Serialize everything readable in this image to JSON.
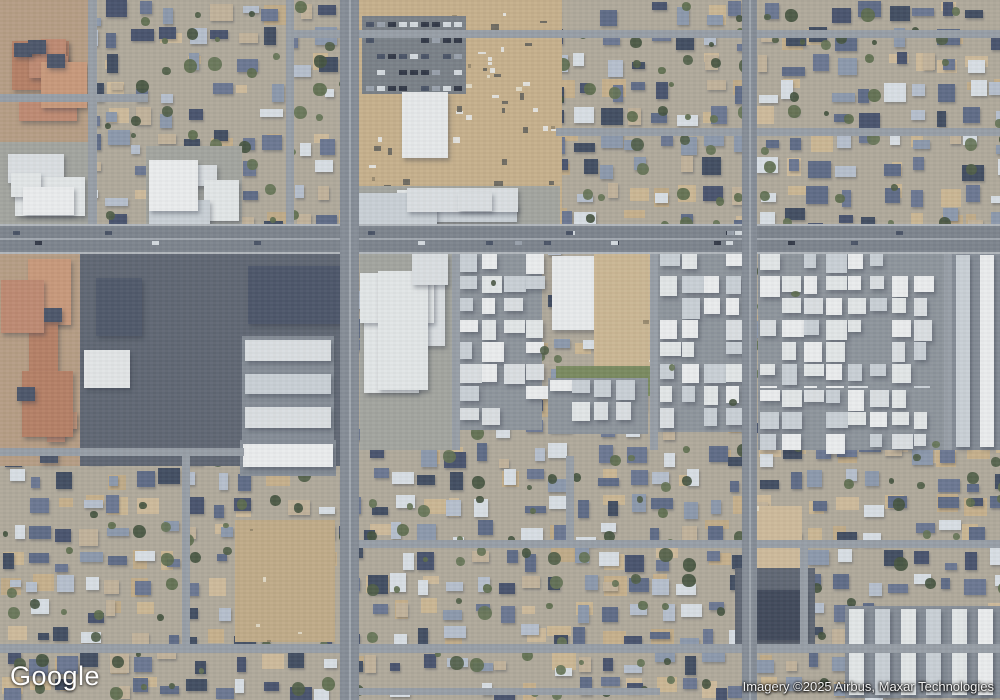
{
  "overlay": {
    "logo_text": "Google",
    "attribution_text": "Imagery ©2025 Airbus, Maxar Technologies"
  },
  "palette": {
    "base_yard": "#b3ab9b",
    "road_major": "#7d838c",
    "road_major_v": "#868d96",
    "road_minor": "#99a0a7",
    "road_stripe": "#a2a8af",
    "dirt": [
      "#cab28b",
      "#cfb993",
      "#c4ad87",
      "#d2bd9b"
    ],
    "grass": "#7a8a5c",
    "parking": "#5e6571",
    "parking_light": "#7a8086",
    "apts_bg": "#8f959c",
    "rows_bg": "#868d96",
    "comm_bg": "#a5a69f",
    "tan_bg": "#b99e83",
    "salmon": [
      "#c28a70",
      "#cc9979",
      "#b87f63"
    ],
    "white_roofs": [
      "#e8ebeb",
      "#dfe3e5",
      "#f1f2f2",
      "#cdd3d8"
    ],
    "house_colors": [
      "#46506b",
      "#5d6a85",
      "#8d99ad",
      "#b9c2cf",
      "#dde3e8",
      "#6b7691",
      "#3f4a5e",
      "#c5b49a"
    ],
    "tree_colors": [
      "#4e5c43",
      "#5c6b4a",
      "#42503b",
      "#647251"
    ],
    "car_colors": [
      "#2e3442",
      "#d8dde2",
      "#9aa2ac",
      "#475063"
    ],
    "dark_roof": "#4a5367"
  },
  "map": {
    "width": 1000,
    "height": 700,
    "zones": [
      {
        "t": "res",
        "x": 0,
        "y": 0,
        "w": 1000,
        "h": 700,
        "s": 11
      },
      {
        "t": "tan_complex",
        "x": 0,
        "y": 0,
        "w": 92,
        "h": 142,
        "s": 21
      },
      {
        "t": "comm",
        "x": 0,
        "y": 142,
        "w": 92,
        "h": 86,
        "s": 22,
        "n": 4
      },
      {
        "t": "comm",
        "x": 146,
        "y": 146,
        "w": 96,
        "h": 82,
        "s": 23,
        "n": 4
      },
      {
        "t": "dirt",
        "x": 352,
        "y": 0,
        "w": 210,
        "h": 226,
        "s": 24,
        "i": 0
      },
      {
        "t": "park_cars",
        "x": 362,
        "y": 16,
        "w": 104,
        "h": 78,
        "s": 25
      },
      {
        "t": "specks",
        "x": 466,
        "y": 8,
        "w": 92,
        "h": 180,
        "s": 27,
        "n": 26
      },
      {
        "t": "specks",
        "x": 360,
        "y": 100,
        "w": 100,
        "h": 112,
        "s": 28,
        "n": 18
      },
      {
        "t": "bldg",
        "x": 402,
        "y": 92,
        "w": 46,
        "h": 66,
        "c": "#eceeee"
      },
      {
        "t": "comm",
        "x": 350,
        "y": 186,
        "w": 210,
        "h": 42,
        "s": 29,
        "n": 6
      },
      {
        "t": "tan_complex",
        "x": 0,
        "y": 252,
        "w": 80,
        "h": 214,
        "s": 31
      },
      {
        "t": "parking",
        "x": 80,
        "y": 252,
        "w": 270,
        "h": 214
      },
      {
        "t": "bldg",
        "x": 96,
        "y": 278,
        "w": 46,
        "h": 58,
        "c": "#4d5668"
      },
      {
        "t": "bldg",
        "x": 84,
        "y": 350,
        "w": 46,
        "h": 38,
        "c": "#e8eaea"
      },
      {
        "t": "bldg",
        "x": 248,
        "y": 266,
        "w": 98,
        "h": 58,
        "c": "#4a5367"
      },
      {
        "t": "rows_h",
        "x": 242,
        "y": 336,
        "w": 92,
        "h": 134,
        "r": 4,
        "s": 32
      },
      {
        "t": "rows_h",
        "x": 240,
        "y": 440,
        "w": 96,
        "h": 36,
        "r": 1,
        "s": 33
      },
      {
        "t": "comm",
        "x": 360,
        "y": 252,
        "w": 92,
        "h": 198,
        "s": 34,
        "n": 5
      },
      {
        "t": "apts",
        "x": 458,
        "y": 252,
        "w": 84,
        "h": 178,
        "s": 35
      },
      {
        "t": "bldg",
        "x": 552,
        "y": 256,
        "w": 46,
        "h": 74,
        "c": "#eef0f0"
      },
      {
        "t": "dirt",
        "x": 594,
        "y": 254,
        "w": 58,
        "h": 112,
        "s": 36,
        "i": 1
      },
      {
        "t": "grass",
        "x": 556,
        "y": 366,
        "w": 94,
        "h": 30
      },
      {
        "t": "apts",
        "x": 548,
        "y": 378,
        "w": 100,
        "h": 56,
        "s": 37
      },
      {
        "t": "apts",
        "x": 658,
        "y": 252,
        "w": 88,
        "h": 180,
        "s": 38
      },
      {
        "t": "apts",
        "x": 758,
        "y": 252,
        "w": 190,
        "h": 180,
        "s": 39
      },
      {
        "t": "apts",
        "x": 758,
        "y": 388,
        "w": 190,
        "h": 62,
        "s": 40
      },
      {
        "t": "rows_v",
        "x": 952,
        "y": 252,
        "w": 48,
        "h": 198,
        "cols": 2,
        "s": 41
      },
      {
        "t": "dirt",
        "x": 235,
        "y": 520,
        "w": 100,
        "h": 122,
        "s": 51,
        "i": 2
      },
      {
        "t": "dirt",
        "x": 742,
        "y": 506,
        "w": 60,
        "h": 64,
        "s": 52,
        "i": 3
      },
      {
        "t": "parking",
        "x": 735,
        "y": 568,
        "w": 80,
        "h": 76
      },
      {
        "t": "bldg",
        "x": 752,
        "y": 590,
        "w": 54,
        "h": 50,
        "c": "#3e4657"
      },
      {
        "t": "rows_v",
        "x": 845,
        "y": 606,
        "w": 155,
        "h": 92,
        "cols": 6,
        "s": 53
      },
      {
        "t": "road_h",
        "x": 0,
        "y": 94,
        "w": 148,
        "h": 8
      },
      {
        "t": "road_h",
        "x": 290,
        "y": 30,
        "w": 710,
        "h": 8
      },
      {
        "t": "road_h",
        "x": 556,
        "y": 128,
        "w": 444,
        "h": 8
      },
      {
        "t": "road_h",
        "x": 0,
        "y": 448,
        "w": 244,
        "h": 8
      },
      {
        "t": "road_h",
        "x": 348,
        "y": 540,
        "w": 652,
        "h": 8
      },
      {
        "t": "road_h",
        "x": 0,
        "y": 644,
        "w": 1000,
        "h": 9
      },
      {
        "t": "road_h",
        "x": 348,
        "y": 688,
        "w": 312,
        "h": 7
      },
      {
        "t": "road_v",
        "x": 88,
        "y": 0,
        "w": 9,
        "h": 228
      },
      {
        "t": "road_v",
        "x": 286,
        "y": 0,
        "w": 8,
        "h": 228
      },
      {
        "t": "road_v",
        "x": 452,
        "y": 252,
        "w": 8,
        "h": 198
      },
      {
        "t": "road_v",
        "x": 650,
        "y": 252,
        "w": 8,
        "h": 198
      },
      {
        "t": "road_v",
        "x": 944,
        "y": 252,
        "w": 8,
        "h": 198
      },
      {
        "t": "road_v",
        "x": 182,
        "y": 456,
        "w": 8,
        "h": 190
      },
      {
        "t": "road_v",
        "x": 566,
        "y": 456,
        "w": 8,
        "h": 86
      },
      {
        "t": "road_v",
        "x": 800,
        "y": 548,
        "w": 8,
        "h": 98
      },
      {
        "t": "road_h",
        "x": 0,
        "y": 226,
        "w": 1000,
        "h": 26,
        "main": true
      },
      {
        "t": "road_v",
        "x": 340,
        "y": 0,
        "w": 19,
        "h": 700,
        "mainv": true
      },
      {
        "t": "road_v",
        "x": 742,
        "y": 0,
        "w": 15,
        "h": 700,
        "mainv": true
      },
      {
        "t": "cars",
        "x": 0,
        "y": 228,
        "w": 1000,
        "h": 22,
        "s": 61,
        "n": 22
      }
    ]
  }
}
